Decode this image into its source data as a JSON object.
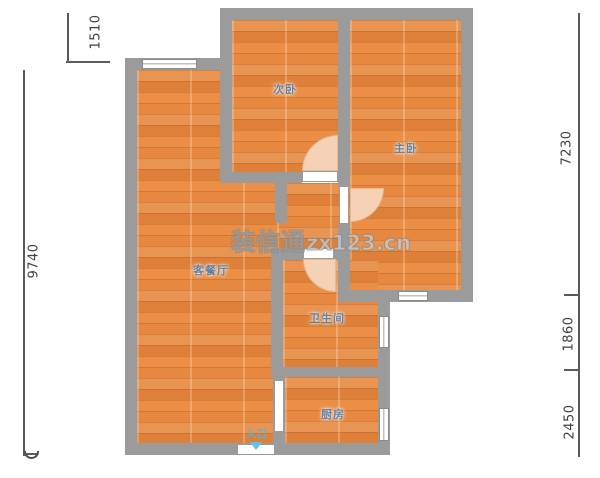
{
  "plan": {
    "watermark": {
      "brand": "装信通",
      "site": "zx123.cn"
    },
    "rooms": [
      {
        "name": "secondary-bedroom",
        "label": "次卧"
      },
      {
        "name": "master-bedroom",
        "label": "主卧"
      },
      {
        "name": "living-dining-room",
        "label": "客餐厅"
      },
      {
        "name": "bathroom",
        "label": "卫生间"
      },
      {
        "name": "kitchen",
        "label": "厨房"
      }
    ],
    "entrance": {
      "label": "入口",
      "arrow_icon": "triangle-down-icon",
      "color": "#49b7e9"
    },
    "dimensions": {
      "left": [
        {
          "value": "1510"
        },
        {
          "value": "9740"
        }
      ],
      "right": [
        {
          "value": "7230"
        },
        {
          "value": "1860"
        },
        {
          "value": "2450"
        }
      ]
    },
    "colors": {
      "wall": "#9b9b9b",
      "floor": "#e6883f",
      "door_arc": "#f5d2b6",
      "room_label": "#64809f",
      "dimension_text": "#3f3f3f",
      "entrance_blue": "#49b7e9"
    }
  }
}
